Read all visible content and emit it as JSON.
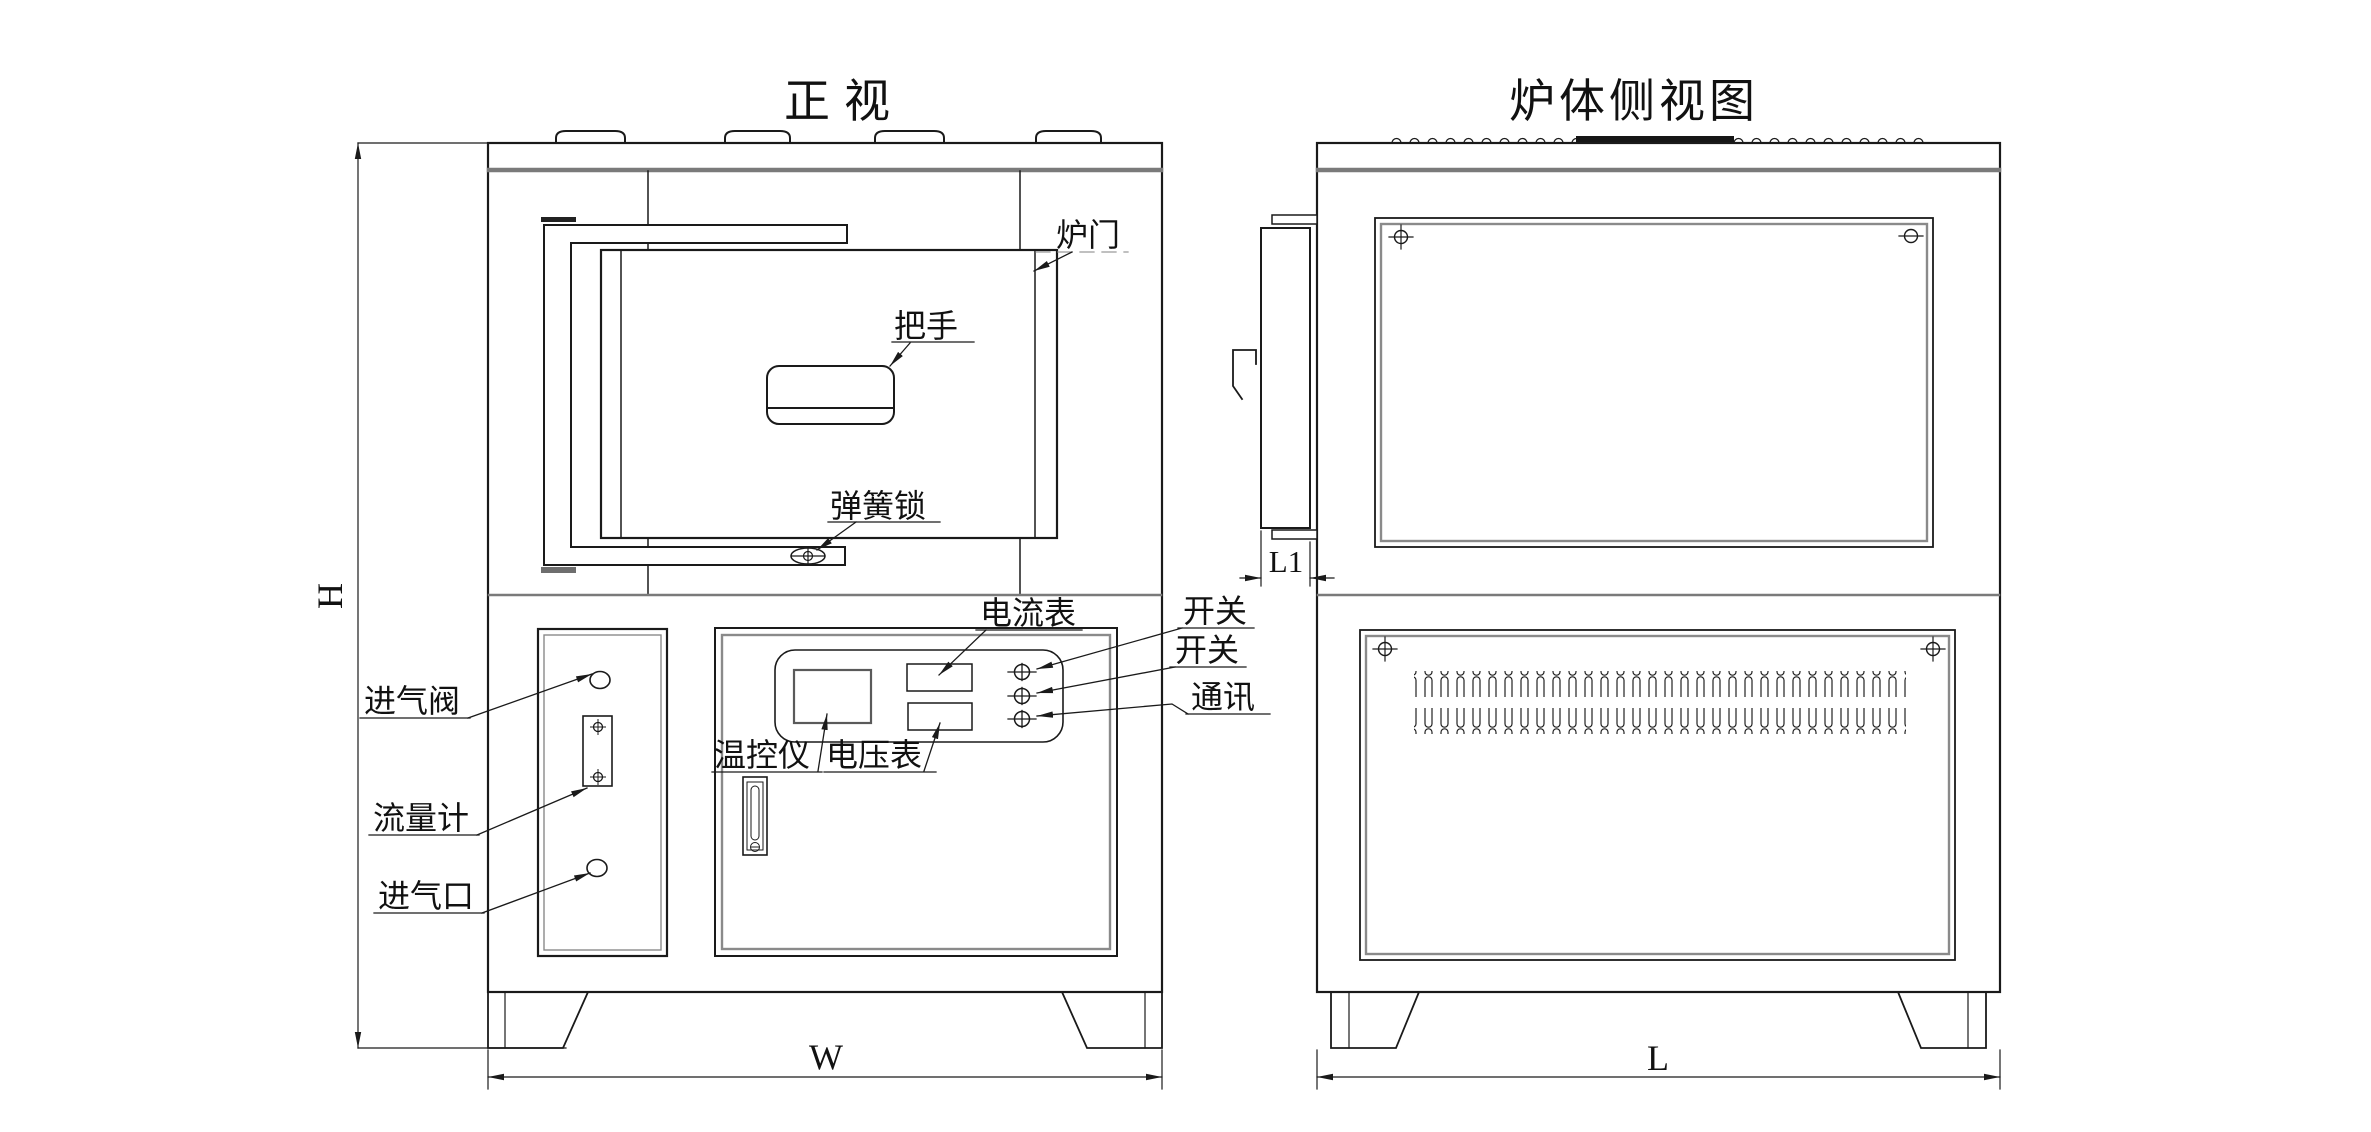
{
  "drawing": {
    "background": "#ffffff",
    "line_color": "#1a1a1a",
    "accent_grey": "#7a7a7a",
    "front_view": {
      "title": "正视",
      "labels": {
        "door": "炉门",
        "handle": "把手",
        "spring_lock": "弹簧锁",
        "ammeter": "电流表",
        "switch_1": "开关",
        "switch_2": "开关",
        "comm": "通讯",
        "intake_valve": "进气阀",
        "temp_controller": "温控仪",
        "voltmeter": "电压表",
        "flow_meter": "流量计",
        "air_inlet": "进气口"
      },
      "dimensions": {
        "height": "H",
        "width": "W"
      }
    },
    "side_view": {
      "title": "炉体侧视图",
      "dimensions": {
        "door_depth": "L1",
        "length": "L"
      }
    }
  }
}
